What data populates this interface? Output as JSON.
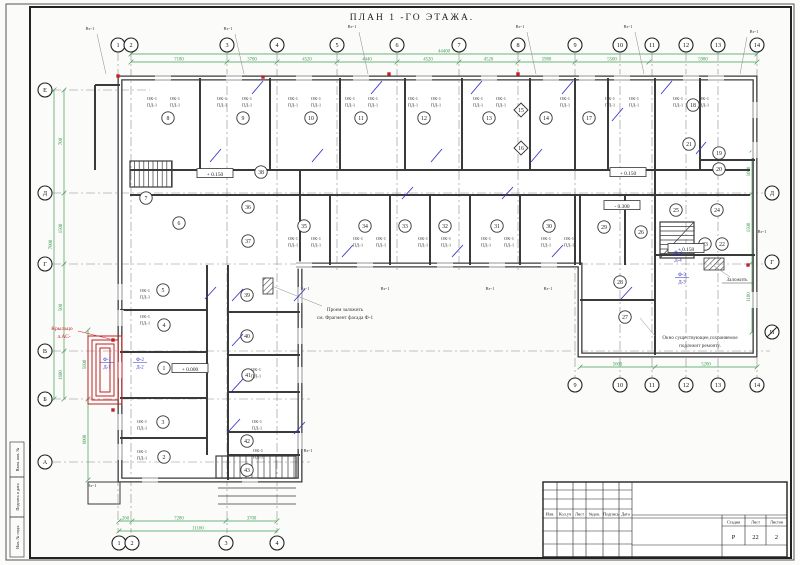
{
  "sheet": {
    "title": "ПЛАН 1 -ГО ЭТАЖА.",
    "stamp": {
      "cols": [
        "Изм.",
        "Кол.уч",
        "Лист",
        "№док.",
        "Подпись",
        "Дата"
      ],
      "stage_label": "Стадия",
      "sheet_label": "Лист",
      "sheets_label": "Листов",
      "stage": "Р",
      "sheet_no": "22",
      "sheets_total": "2"
    },
    "margins": [
      "Взам. инв. №",
      "Подпись и дата",
      "Инв. № подл."
    ]
  },
  "plan": {
    "colors": {
      "line": "#3a3a3a",
      "dim": "#3f9e53",
      "red": "#c22222",
      "blue": "#3535c8",
      "grid": "#8a8a8a"
    },
    "axes_top": [
      [
        "1",
        118
      ],
      [
        "2",
        131
      ],
      [
        "3",
        227
      ],
      [
        "4",
        277
      ],
      [
        "5",
        337
      ],
      [
        "6",
        397
      ],
      [
        "7",
        459
      ],
      [
        "8",
        518
      ],
      [
        "9",
        575
      ],
      [
        "10",
        620
      ],
      [
        "11",
        652
      ],
      [
        "12",
        686
      ],
      [
        "13",
        718
      ],
      [
        "14",
        757
      ]
    ],
    "axes_bottom_left": [
      [
        "1",
        119
      ],
      [
        "2",
        132
      ],
      [
        "3",
        226
      ],
      [
        "4",
        277
      ]
    ],
    "axes_bottom_right": [
      [
        "9",
        575
      ],
      [
        "10",
        620
      ],
      [
        "11",
        652
      ],
      [
        "12",
        686
      ],
      [
        "13",
        718
      ],
      [
        "14",
        757
      ]
    ],
    "axes_left": [
      [
        "Е",
        90
      ],
      [
        "Д",
        193
      ],
      [
        "Г",
        264
      ],
      [
        "В",
        351
      ],
      [
        "Б",
        399
      ],
      [
        "А",
        462
      ]
    ],
    "axes_right": [
      [
        "Д",
        193
      ],
      [
        "Г",
        262
      ],
      [
        "И",
        332
      ]
    ],
    "dims": {
      "top_spans": [
        [
          131,
          227,
          "7180"
        ],
        [
          227,
          277,
          "3700"
        ],
        [
          277,
          337,
          "4520"
        ],
        [
          337,
          397,
          "4440"
        ],
        [
          397,
          459,
          "4520"
        ],
        [
          459,
          518,
          "4520"
        ],
        [
          518,
          575,
          "5980"
        ],
        [
          575,
          649,
          "5500"
        ],
        [
          649,
          757,
          "5980"
        ]
      ],
      "top_total": "44400",
      "bottom_spans": [
        [
          119,
          132,
          "260"
        ],
        [
          132,
          226,
          "7280"
        ],
        [
          226,
          277,
          "3700"
        ]
      ],
      "bottom_total": "11160",
      "rwing_spans": [
        [
          580,
          655,
          "5600"
        ],
        [
          655,
          757,
          "5200"
        ]
      ],
      "left_spans": [
        [
          90,
          193,
          "700"
        ],
        [
          193,
          264,
          "1500"
        ],
        [
          264,
          351,
          "500"
        ],
        [
          351,
          399,
          "1600"
        ]
      ],
      "left_total": "7000",
      "left_lower_spans": [
        [
          330,
          399,
          "5600"
        ],
        [
          399,
          480,
          "6000"
        ]
      ],
      "right_spans": [
        [
          150,
          193,
          "1060"
        ],
        [
          193,
          262,
          "1500"
        ],
        [
          262,
          332,
          "1100"
        ]
      ]
    },
    "rooms": [
      [
        "8",
        168,
        118
      ],
      [
        "9",
        243,
        118
      ],
      [
        "10",
        311,
        118
      ],
      [
        "11",
        361,
        118
      ],
      [
        "12",
        424,
        118
      ],
      [
        "13",
        489,
        118
      ],
      [
        "14",
        546,
        118
      ],
      [
        "17",
        589,
        118
      ],
      [
        "18",
        693,
        105
      ],
      [
        "21",
        689,
        144
      ],
      [
        "19",
        719,
        153
      ],
      [
        "20",
        719,
        169
      ],
      [
        "38",
        261,
        172
      ],
      [
        "7",
        146,
        198
      ],
      [
        "6",
        179,
        223
      ],
      [
        "36",
        248,
        207
      ],
      [
        "37",
        248,
        241
      ],
      [
        "35",
        304,
        226
      ],
      [
        "34",
        365,
        226
      ],
      [
        "33",
        405,
        226
      ],
      [
        "32",
        445,
        226
      ],
      [
        "31",
        497,
        226
      ],
      [
        "30",
        549,
        226
      ],
      [
        "29",
        604,
        227
      ],
      [
        "26",
        641,
        232
      ],
      [
        "25",
        676,
        210
      ],
      [
        "24",
        717,
        210
      ],
      [
        "23",
        705,
        244
      ],
      [
        "22",
        722,
        244
      ],
      [
        "28",
        620,
        282
      ],
      [
        "27",
        625,
        317
      ],
      [
        "5",
        163,
        290
      ],
      [
        "4",
        164,
        325
      ],
      [
        "1",
        164,
        368
      ],
      [
        "39",
        247,
        295
      ],
      [
        "40",
        247,
        336
      ],
      [
        "41",
        248,
        375
      ],
      [
        "3",
        163,
        422
      ],
      [
        "2",
        164,
        457
      ],
      [
        "42",
        247,
        441
      ],
      [
        "43",
        247,
        470
      ]
    ],
    "diamonds": [
      [
        "15",
        521,
        110
      ],
      [
        "16",
        521,
        148
      ]
    ],
    "window_label": {
      "l1": "ОК-1",
      "l2": "ПД-1"
    },
    "window_label_pos": [
      [
        152,
        100
      ],
      [
        175,
        100
      ],
      [
        222,
        100
      ],
      [
        247,
        100
      ],
      [
        293,
        100
      ],
      [
        316,
        100
      ],
      [
        350,
        100
      ],
      [
        373,
        100
      ],
      [
        413,
        100
      ],
      [
        436,
        100
      ],
      [
        478,
        100
      ],
      [
        501,
        100
      ],
      [
        565,
        100
      ],
      [
        610,
        100
      ],
      [
        634,
        100
      ],
      [
        678,
        100
      ],
      [
        704,
        100
      ],
      [
        293,
        240
      ],
      [
        316,
        240
      ],
      [
        358,
        240
      ],
      [
        381,
        240
      ],
      [
        423,
        240
      ],
      [
        446,
        240
      ],
      [
        486,
        240
      ],
      [
        509,
        240
      ],
      [
        546,
        240
      ],
      [
        569,
        240
      ],
      [
        145,
        292
      ],
      [
        145,
        318
      ],
      [
        142,
        423
      ],
      [
        142,
        453
      ],
      [
        256,
        371
      ],
      [
        257,
        423
      ],
      [
        258,
        452
      ]
    ],
    "vt_label": "Вт-1",
    "vt_pos": [
      [
        90,
        30
      ],
      [
        228,
        30
      ],
      [
        352,
        28
      ],
      [
        520,
        28
      ],
      [
        628,
        28
      ],
      [
        754,
        33
      ],
      [
        305,
        290
      ],
      [
        385,
        290
      ],
      [
        490,
        290
      ],
      [
        548,
        290
      ],
      [
        92,
        487
      ],
      [
        762,
        233
      ],
      [
        308,
        452
      ]
    ],
    "elevations": [
      [
        "+ 0.150",
        215,
        174
      ],
      [
        "+ 0.150",
        628,
        173
      ],
      [
        "- 0.300",
        622,
        206
      ],
      [
        "+ 0.150",
        686,
        249
      ],
      [
        "+ 0.000",
        190,
        369
      ]
    ],
    "fractions": [
      [
        "Ф-1",
        "Д-1",
        107,
        361
      ],
      [
        "Ф-2",
        "Д-2",
        140,
        361
      ],
      [
        "Ф-3",
        "Д-4",
        678,
        254
      ],
      [
        "Ф-3",
        "Д-3",
        682,
        276
      ]
    ],
    "notes": {
      "infill_1": "Проем заложить",
      "infill_2": "см. Фрагмент фасада Ф-1",
      "window_1": "Окно существующее,сохраняемое",
      "window_2": "подлежит ремонту.",
      "zalozhit": "Заложить",
      "porch_1": "Крыльцо",
      "porch_2": "л.АС-"
    },
    "red_dots": [
      [
        118,
        76
      ],
      [
        263,
        77
      ],
      [
        389,
        74
      ],
      [
        518,
        74
      ],
      [
        113,
        340
      ],
      [
        113,
        410
      ],
      [
        748,
        265
      ]
    ],
    "blue_doors": [
      [
        210,
        162,
        221,
        149
      ],
      [
        252,
        94,
        263,
        81
      ],
      [
        312,
        162,
        323,
        149
      ],
      [
        371,
        94,
        382,
        81
      ],
      [
        431,
        162,
        442,
        149
      ],
      [
        471,
        94,
        482,
        81
      ],
      [
        531,
        162,
        542,
        149
      ],
      [
        562,
        94,
        573,
        81
      ],
      [
        612,
        121,
        623,
        108
      ],
      [
        661,
        94,
        672,
        81
      ],
      [
        696,
        154,
        706,
        142
      ],
      [
        342,
        257,
        353,
        245
      ],
      [
        402,
        199,
        413,
        187
      ],
      [
        452,
        257,
        463,
        245
      ],
      [
        502,
        199,
        513,
        187
      ],
      [
        552,
        257,
        563,
        245
      ],
      [
        621,
        299,
        632,
        287
      ],
      [
        232,
        301,
        243,
        289
      ],
      [
        232,
        346,
        243,
        334
      ],
      [
        232,
        391,
        243,
        379
      ],
      [
        229,
        431,
        240,
        419
      ],
      [
        294,
        301,
        305,
        289
      ],
      [
        294,
        434,
        305,
        422
      ],
      [
        205,
        299,
        216,
        287
      ]
    ]
  }
}
